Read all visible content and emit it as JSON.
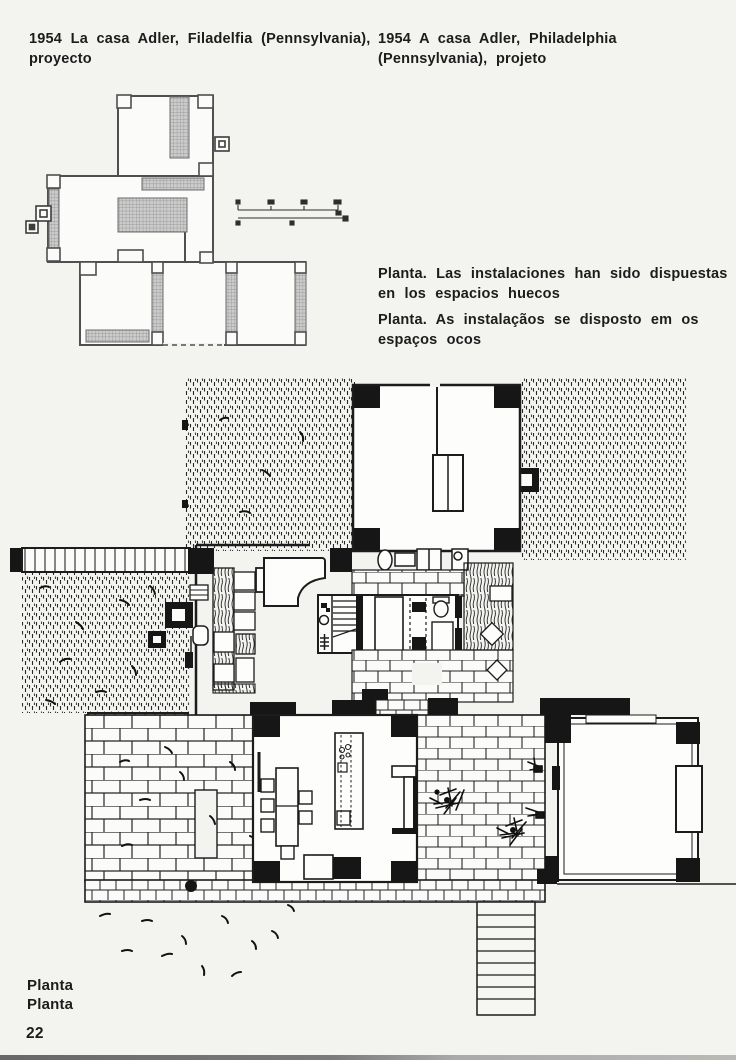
{
  "page": {
    "number": "22",
    "paper_color": "#f3f3f0",
    "ink_color": "#1c1c1c"
  },
  "header": {
    "left_title_line1": "1954   La casa Adler, Filadelfia (Pennsylvania),",
    "left_title_line2": "proyecto",
    "right_title_line1": "1954   A casa Adler, Philadelphia",
    "right_title_line2": "(Pennsylvania),  projeto"
  },
  "captions": {
    "es_line1": "Planta. Las instalaciones han sido dispuestas",
    "es_line2": "en los espacios huecos",
    "pt_line1": "Planta. As instalaçãos se disposto em os",
    "pt_line2": "espaços ocos"
  },
  "figure_labels": {
    "line1": "Planta",
    "line2": "Planta"
  }
}
